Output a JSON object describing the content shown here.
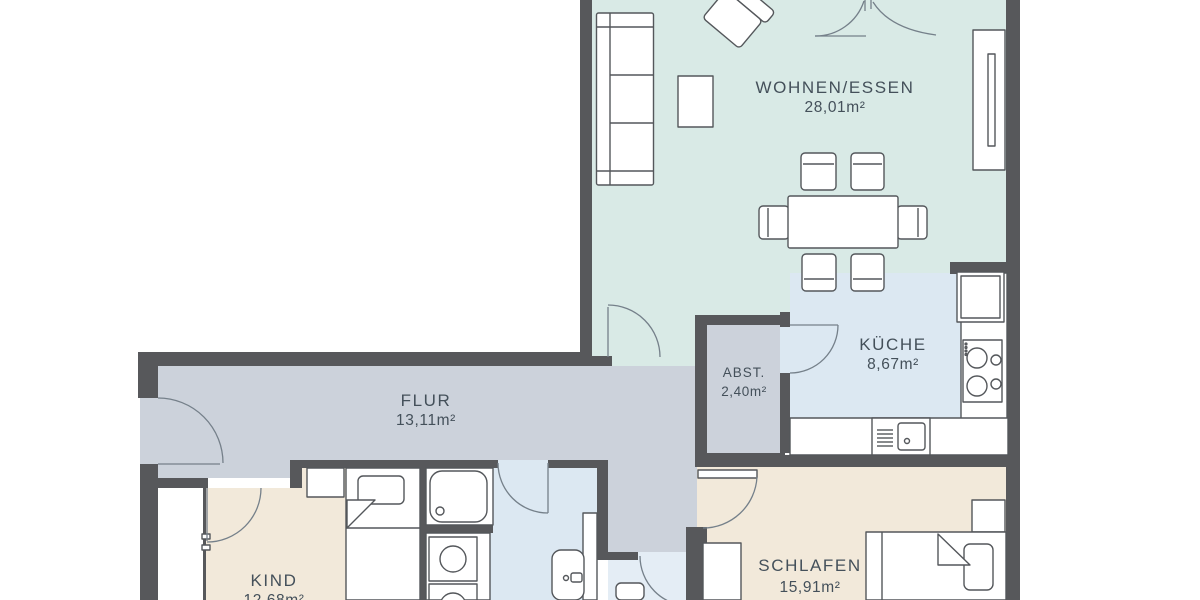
{
  "palette": {
    "wall": "#57585b",
    "outline": "#54575b",
    "door_arc": "#75808a",
    "text": "#44505a",
    "floor_living": "#d9eae6",
    "floor_kitchen": "#dce8f2",
    "floor_bath": "#dce8f2",
    "floor_hall": "#ccd2db",
    "floor_bedroom": "#f2e9da",
    "floor_wc": "#e4edf5",
    "canvas": "#ffffff"
  },
  "rooms": [
    {
      "id": "living",
      "label": "WOHNEN/ESSEN",
      "area": "28,01m²"
    },
    {
      "id": "kitchen",
      "label": "KÜCHE",
      "area": "8,67m²"
    },
    {
      "id": "storage",
      "label": "ABST.",
      "area": "2,40m²"
    },
    {
      "id": "hall",
      "label": "FLUR",
      "area": "13,11m²"
    },
    {
      "id": "child",
      "label": "KIND",
      "area": "12,68m²"
    },
    {
      "id": "bedroom",
      "label": "SCHLAFEN",
      "area": "15,91m²"
    }
  ]
}
